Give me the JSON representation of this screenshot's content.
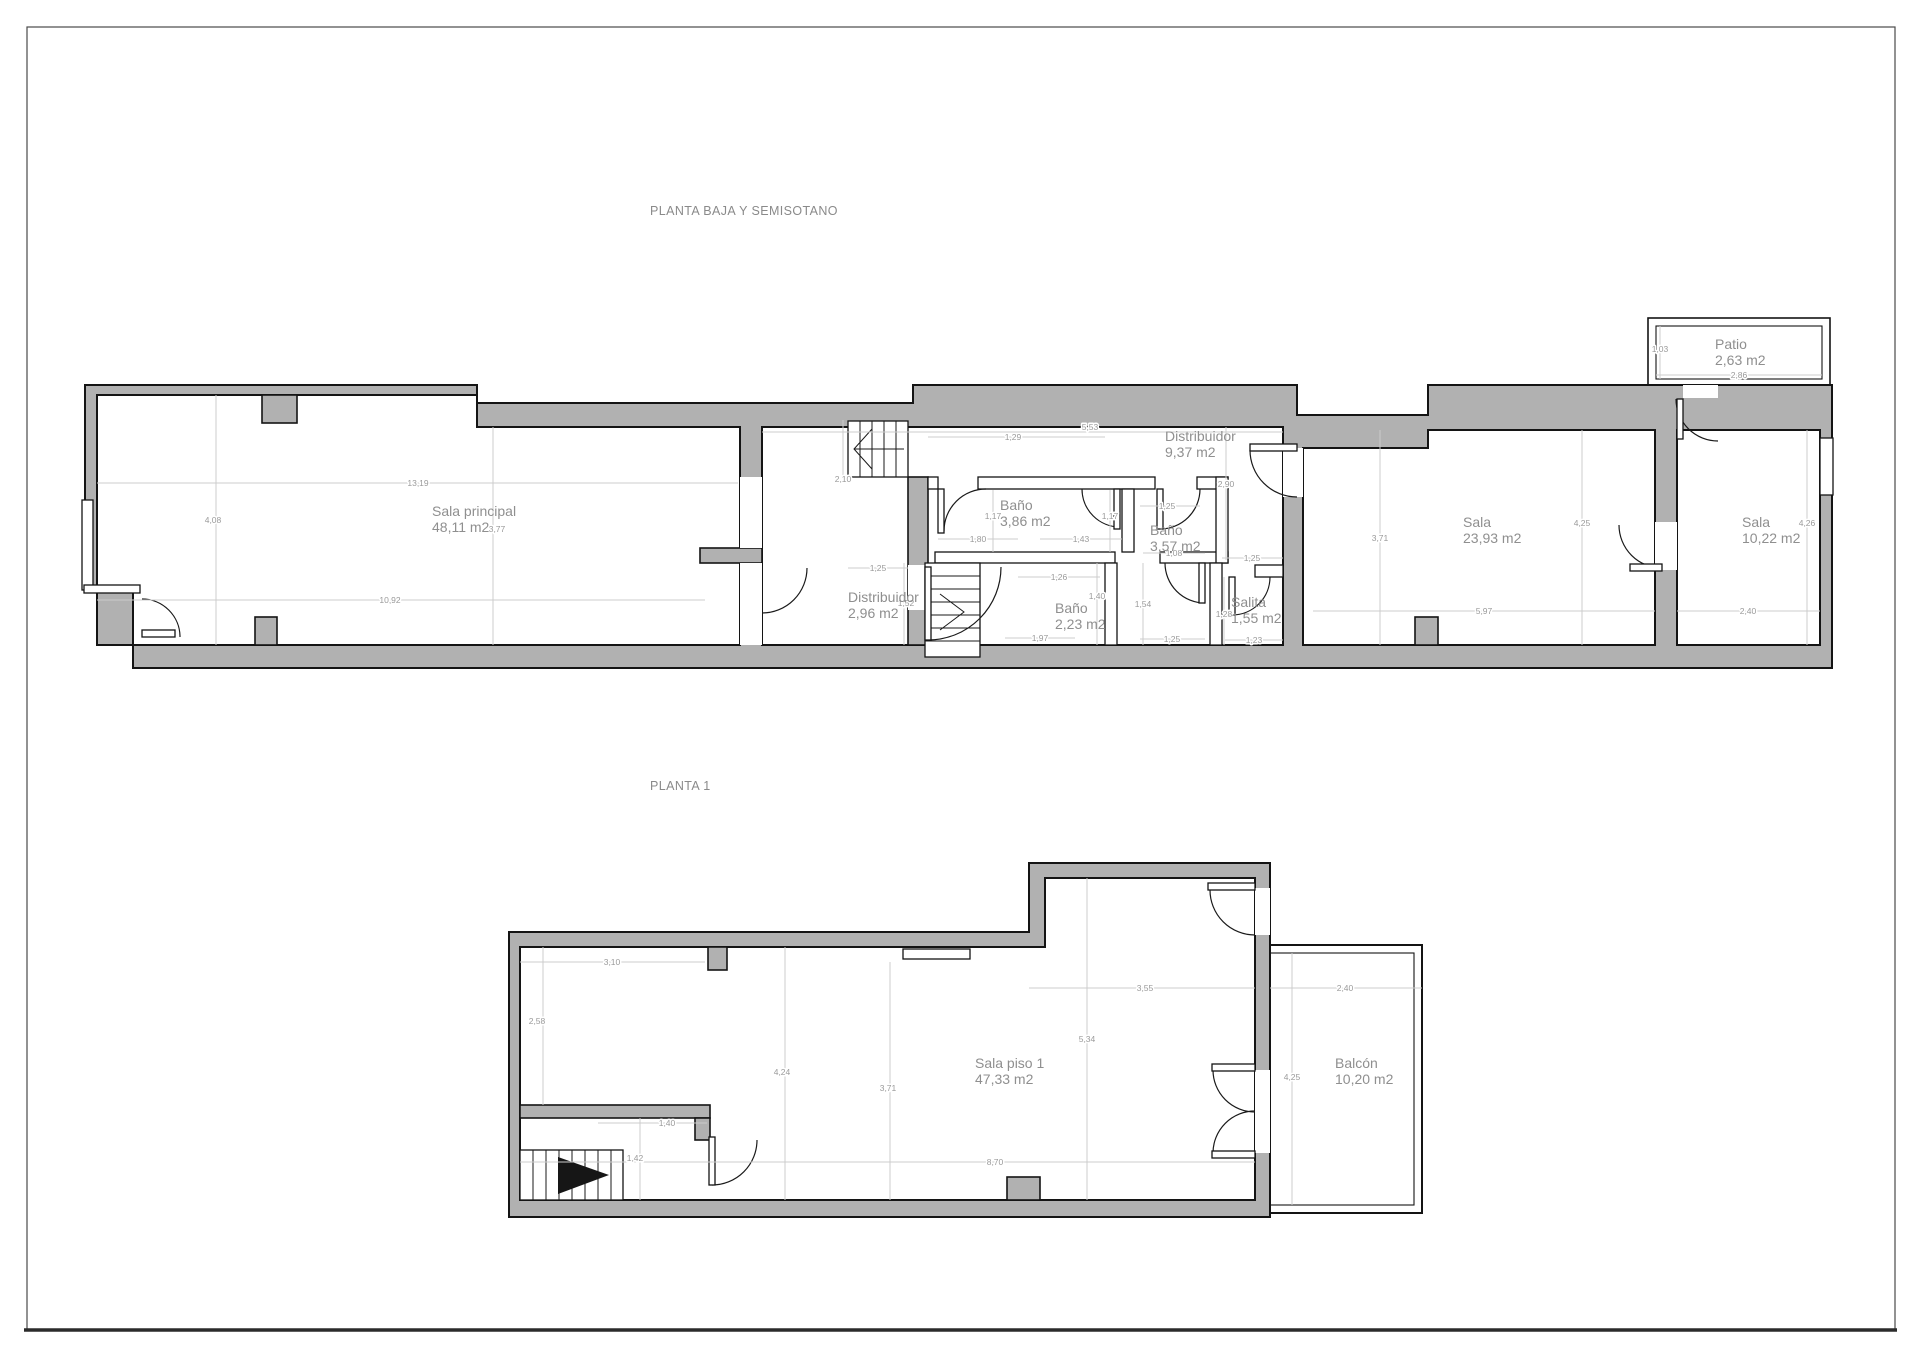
{
  "titles": {
    "plan1": "PLANTA BAJA Y SEMISOTANO",
    "plan2": "PLANTA 1"
  },
  "colors": {
    "wall_fill": "#b1b1b1",
    "wall_outline": "#141414",
    "dimension_line": "#cccccc",
    "dimension_text": "#9a9a9a",
    "label_text": "#8f8f8f"
  },
  "plan1": {
    "rooms": [
      {
        "name": "Sala principal",
        "area": "48,11 m2"
      },
      {
        "name": "Distribuidor",
        "area": "9,37 m2"
      },
      {
        "name": "Baño",
        "area": "3,86 m2"
      },
      {
        "name": "Baño",
        "area": "3,57 m2"
      },
      {
        "name": "Distribuidor",
        "area": "2,96 m2"
      },
      {
        "name": "Baño",
        "area": "2,23 m2"
      },
      {
        "name": "Salita",
        "area": "1,55 m2"
      },
      {
        "name": "Sala",
        "area": "23,93 m2"
      },
      {
        "name": "Sala",
        "area": "10,22 m2"
      },
      {
        "name": "Patio",
        "area": "2,63 m2"
      }
    ],
    "dims": [
      "13,19",
      "4,08",
      "3,77",
      "10,92",
      "2,10",
      "1,29",
      "5,53",
      "2,90",
      "1,17",
      "1,17",
      "1,80",
      "1,43",
      "1,25",
      "1,08",
      "1,25",
      "1,25",
      "1,26",
      "1,52",
      "1,40",
      "1,54",
      "1,97",
      "1,25",
      "1,23",
      "1,28",
      "3,71",
      "4,25",
      "4,26",
      "5,97",
      "2,40",
      "1,03",
      "2,86"
    ]
  },
  "plan2": {
    "rooms": [
      {
        "name": "Sala piso 1",
        "area": "47,33 m2"
      },
      {
        "name": "Balcón",
        "area": "10,20 m2"
      }
    ],
    "dims": [
      "3,10",
      "2,58",
      "4,24",
      "3,71",
      "1,40",
      "1,42",
      "3,55",
      "5,34",
      "4,25",
      "2,40",
      "8,70"
    ]
  }
}
